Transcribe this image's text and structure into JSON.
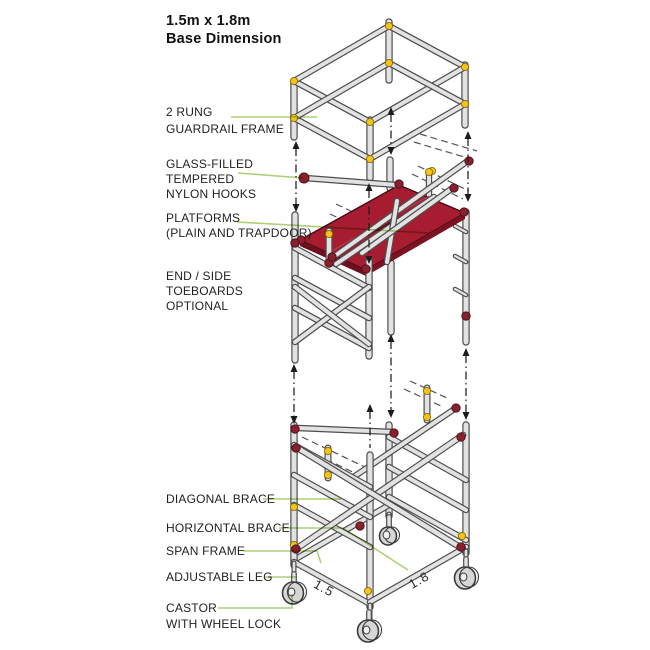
{
  "title": "1.5m x 1.8m\nBase Dimension",
  "labels": {
    "guardrail_frame": "2 RUNG\nGUARDRAIL FRAME",
    "nylon_hooks": "GLASS-FILLED\nTEMPERED\nNYLON HOOKS",
    "platforms": "PLATFORMS\n(PLAIN AND TRAPDOOR)",
    "toeboards": "END / SIDE\nTOEBOARDS\nOPTIONAL",
    "diagonal_brace": "DIAGONAL BRACE",
    "horizontal_brace": "HORIZONTAL BRACE",
    "span_frame": "SPAN FRAME",
    "adjustable_leg": "ADJUSTABLE LEG",
    "castor": "CASTOR\nWITH WHEEL LOCK"
  },
  "dimensions": {
    "depth_m": "1.5",
    "width_m": "1.8"
  },
  "colors": {
    "background": "#ffffff",
    "text": "#1f1f1f",
    "leader_green": "#aed077",
    "platform_red": "#a81c32",
    "platform_side_dark": "#6d0f1f",
    "platform_side": "#7c1222",
    "clip_yellow": "#f2c41d",
    "clamp_red": "#8c1f2d",
    "tube_fill": "#e2e2e2",
    "tube_outline": "#4d4d4d",
    "arrow_dark": "#1c1c1c"
  }
}
